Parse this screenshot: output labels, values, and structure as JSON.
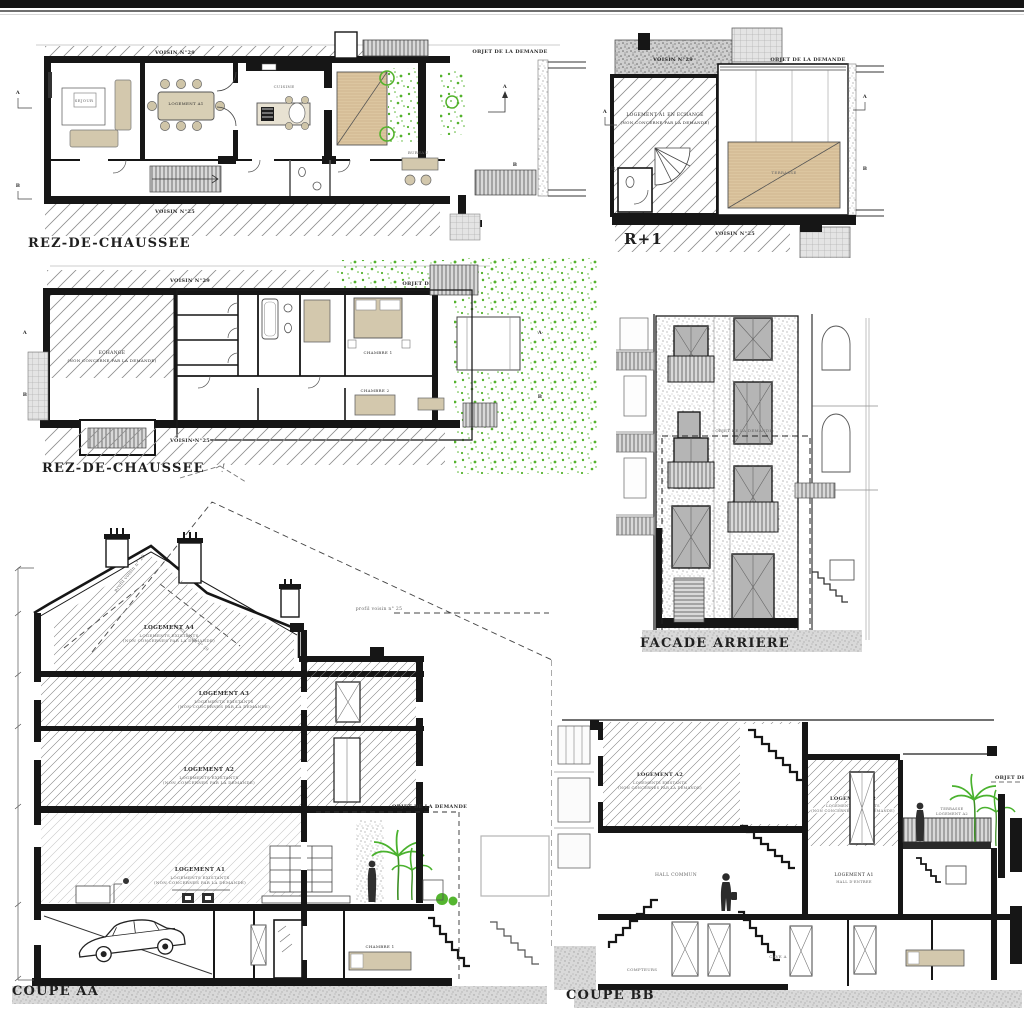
{
  "sheet": {
    "bg": "#ffffff",
    "top_bar_color": "#141414",
    "ink": "#1c1c1c",
    "accent_green": "#55b32e",
    "wood_color": "#dcc6a0",
    "glass_color": "#b5b5b5"
  },
  "plan_rdc_1": {
    "title": "REZ-DE-CHAUSSEE",
    "neighbor_top": "VOISIN N°29",
    "neighbor_bottom": "VOISIN N°25",
    "object_label": "OBJET DE LA DEMANDE",
    "room_sejour": "SEJOUR",
    "room_logement": "LOGEMENT A1",
    "room_cuisine": "CUISINE",
    "room_bureau": "BUREAU",
    "marker_a": "A",
    "marker_b": "B"
  },
  "plan_r1": {
    "title": "R+1",
    "neighbor_top": "VOISIN N°29",
    "neighbor_bottom": "VOISIN N°25",
    "object_label": "OBJET DE LA DEMANDE",
    "unit_line1": "LOGEMENT A1 EN ECHANGE",
    "unit_line2": "(NON CONCERNE PAR LA DEMANDE)",
    "terrace": "TERRASSE",
    "marker_a": "A",
    "marker_b": "B"
  },
  "plan_rdc_2": {
    "title": "REZ-DE-CHAUSSEE",
    "neighbor_top": "VOISIN N°29",
    "neighbor_bottom": "VOISIN N°25",
    "object_label": "OBJET DE LA DEMANDE",
    "exchange_line1": "ECHANGE",
    "exchange_line2": "(NON CONCERNE PAR LA DEMANDE)",
    "room_chambre1": "CHAMBRE 1",
    "room_chambre2": "CHAMBRE 2",
    "marker_a": "A",
    "marker_b": "B"
  },
  "facade": {
    "title": "FACADE ARRIERE",
    "object_label": "OBJET DE LA DEMANDE"
  },
  "coupe_aa": {
    "title": "COUPE AA",
    "lvl_a4": "LOGEMENT A4",
    "lvl_a3": "LOGEMENT A3",
    "lvl_a2": "LOGEMENT A2",
    "lvl_a1": "LOGEMENT A1",
    "existing_sub1": "LOGEMENTS EXISTANTS",
    "existing_sub2": "(NON CONCERNES PAR LA DEMANDE)",
    "profil_29": "profil voisin n° 29",
    "profil_25": "profil voisin n° 25",
    "object_label": "OBJET DE LA DEMANDE",
    "room_chambre": "CHAMBRE 1"
  },
  "coupe_bb": {
    "title": "COUPE BB",
    "unit_left": "LOGEMENT A2",
    "unit_right": "LOGEMENT A2",
    "existing_sub1": "LOGEMENTS EXISTANTS",
    "existing_sub2": "(NON CONCERNES PAR LA DEMANDE)",
    "unit_a1": "LOGEMENT A1",
    "hall_entree": "HALL D'ENTREE",
    "hall_commun": "HALL COMMUN",
    "compteurs": "COMPTEURS",
    "cave": "CAVE A",
    "terrace_line1": "TERRASSE",
    "terrace_line2": "LOGEMENT A2",
    "object_label": "OBJET DE LA DEMANDE"
  }
}
